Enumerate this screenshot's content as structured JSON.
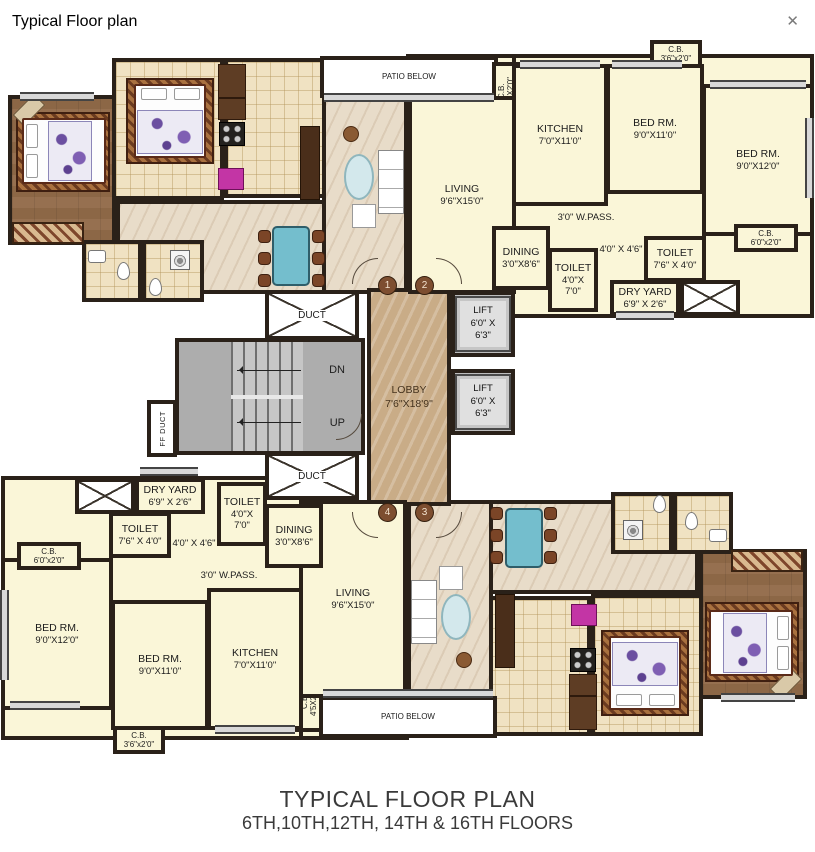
{
  "header": {
    "title": "Typical Floor plan",
    "close": "✕"
  },
  "caption": {
    "line1": "TYPICAL FLOOR PLAN",
    "line2": "6TH,10TH,12TH, 14TH & 16TH FLOORS"
  },
  "core": {
    "duct_top": "DUCT",
    "duct_bottom": "DUCT",
    "ff_duct": "FF DUCT",
    "dn": "DN",
    "up": "UP",
    "lobby_name": "LOBBY",
    "lobby_dim": "7'6\"X18'9\"",
    "lift_name": "LIFT",
    "lift_dim": "6'0\" X 6'3\"",
    "tags": {
      "t1": "1",
      "t2": "2",
      "t3": "3",
      "t4": "4"
    }
  },
  "flat_a": {
    "patio": "PATIO BELOW",
    "cb_vert": {
      "name": "C.B.",
      "dim": "4'5X2'0\""
    },
    "cb_corner": {
      "name": "C.B.",
      "dim": "3'6\"x2'0\""
    },
    "cb_side": {
      "name": "C.B.",
      "dim": "6'0\"x2'0\""
    },
    "kitchen": {
      "name": "KITCHEN",
      "dim": "7'0\"X11'0\""
    },
    "bed1": {
      "name": "BED RM.",
      "dim": "9'0\"X11'0\""
    },
    "bed2": {
      "name": "BED RM.",
      "dim": "9'0\"X12'0\""
    },
    "living": {
      "name": "LIVING",
      "dim": "9'6\"X15'0\""
    },
    "dining": {
      "name": "DINING",
      "dim": "3'0\"X8'6\""
    },
    "toilet1": {
      "name": "TOILET",
      "dim1": "4'0\"X",
      "dim2": "7'0\""
    },
    "toilet2": {
      "name": "TOILET",
      "dim": "7'6\" X 4'0\""
    },
    "dry_yard": {
      "name": "DRY YARD",
      "dim": "6'9\" X 2'6\""
    },
    "wpass": "3'0\" W.PASS.",
    "pass": "4'0\" X 4'6\""
  },
  "flat_b": {
    "patio": "PATIO BELOW",
    "cb_vert": {
      "name": "C.B.",
      "dim": "4'5X2'0\""
    },
    "cb_corner": {
      "name": "C.B.",
      "dim": "3'6\"x2'0\""
    },
    "cb_side": {
      "name": "C.B.",
      "dim": "6'0\"x2'0\""
    },
    "kitchen": {
      "name": "KITCHEN",
      "dim": "7'0\"X11'0\""
    },
    "bed1": {
      "name": "BED RM.",
      "dim": "9'0\"X11'0\""
    },
    "bed2": {
      "name": "BED RM.",
      "dim": "9'0\"X12'0\""
    },
    "living": {
      "name": "LIVING",
      "dim": "9'6\"X15'0\""
    },
    "dining": {
      "name": "DINING",
      "dim": "3'0\"X8'6\""
    },
    "toilet1": {
      "name": "TOILET",
      "dim1": "4'0\"X",
      "dim2": "7'0\""
    },
    "toilet2": {
      "name": "TOILET",
      "dim": "7'6\" X 4'0\""
    },
    "dry_yard": {
      "name": "DRY YARD",
      "dim": "6'9\" X 2'6\""
    },
    "wpass": "3'0\" W.PASS.",
    "pass": "4'0\" X 4'6\""
  }
}
